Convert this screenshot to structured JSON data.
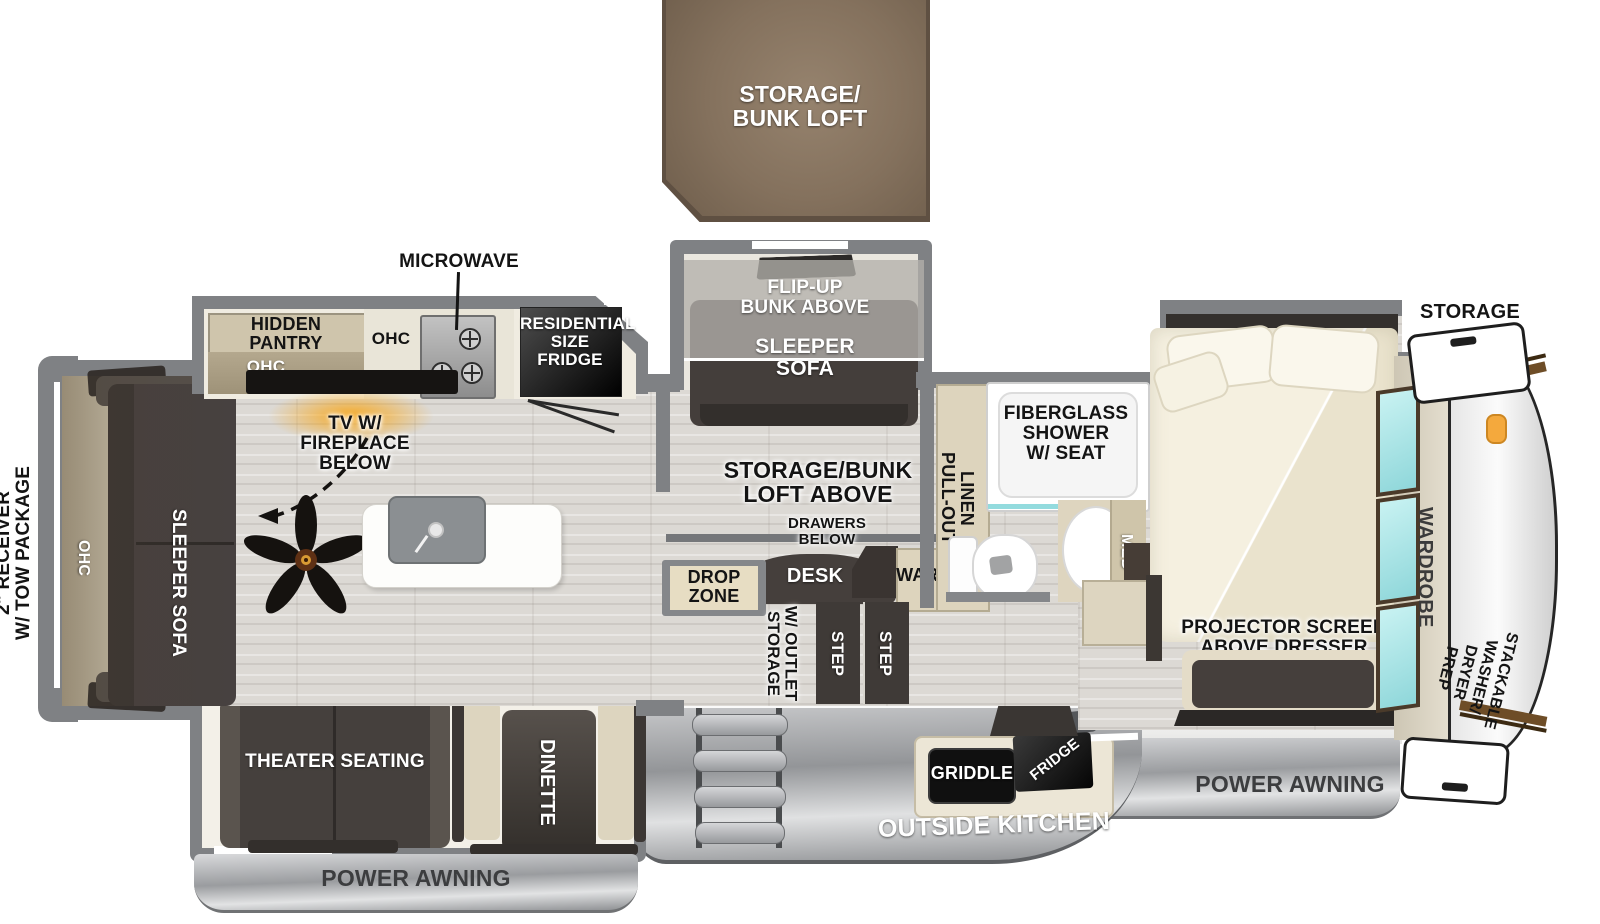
{
  "exterior": {
    "loft": {
      "lines": [
        "STORAGE/",
        "BUNK LOFT"
      ]
    },
    "receiver": {
      "lines": [
        "2\" RECEIVER",
        "W/ TOW PACKAGE"
      ]
    },
    "storage_front_label": "STORAGE",
    "awning_door_side": "POWER AWNING",
    "awning_front": "POWER AWNING",
    "outside_kitchen": "OUTSIDE KITCHEN",
    "griddle": "GRIDDLE",
    "ext_fridge": "FRIDGE"
  },
  "kitchen": {
    "microwave": "MICROWAVE",
    "hidden_pantry": {
      "lines": [
        "HIDDEN",
        "PANTRY"
      ]
    },
    "ohc_pantry": "OHC",
    "ohc_counter": "OHC",
    "residential_fridge": {
      "lines": [
        "RESIDENTIAL",
        "SIZE",
        "FRIDGE"
      ]
    },
    "tv_fireplace": {
      "lines": [
        "TV W/",
        "FIREPLACE BELOW"
      ]
    }
  },
  "living": {
    "rear_sleeper_sofa": "SLEEPER SOFA",
    "rear_ohc": "OHC",
    "theater_seating": "THEATER SEATING",
    "dinette": "DINETTE"
  },
  "bunk_room": {
    "flip_up_bunk": {
      "lines": [
        "FLIP-UP",
        "BUNK ABOVE"
      ]
    },
    "sleeper_sofa": {
      "lines": [
        "SLEEPER",
        "SOFA"
      ]
    },
    "loft_above": {
      "lines": [
        "STORAGE/BUNK",
        "LOFT ABOVE"
      ]
    },
    "drawers_below": {
      "lines": [
        "DRAWERS",
        "BELOW"
      ]
    },
    "desk": "DESK",
    "ward": "WARD",
    "drop_zone": {
      "lines": [
        "DROP",
        "ZONE"
      ]
    },
    "storage_outlet": {
      "lines": [
        "STORAGE",
        "W/ OUTLET"
      ]
    },
    "step_1": "STEP",
    "step_2": "STEP"
  },
  "bathroom": {
    "pull_out_linen": {
      "lines": [
        "PULL-OUT",
        "LINEN"
      ]
    },
    "shower": {
      "lines": [
        "FIBERGLASS",
        "SHOWER",
        "W/ SEAT"
      ]
    },
    "med": "MED"
  },
  "bedroom": {
    "projector": {
      "lines": [
        "PROJECTOR SCREEN",
        "ABOVE DRESSER"
      ]
    },
    "wardrobe": "WARDROBE",
    "washer_prep": {
      "lines": [
        "STACKABLE",
        "WASHER/",
        "DRYER",
        "PREP"
      ]
    }
  },
  "colors": {
    "wall_gray": "#7f8184",
    "floor_wood": "#dcd9d4",
    "furniture_dark": "#453f3c",
    "cabinet_tan": "#ddd4bd",
    "loft_brown": "#8a7560",
    "fireplace_glow": "#f4a01e",
    "mirror_teal": "#aee9ea",
    "awning_silver": "#a9abae"
  }
}
